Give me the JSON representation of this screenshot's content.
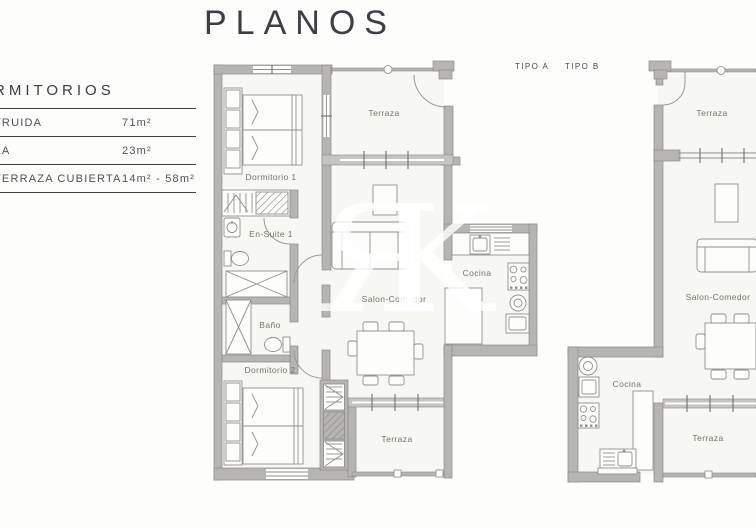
{
  "title": "PLANOS",
  "legend": {
    "heading": "RMITORIOS",
    "rows": [
      {
        "label": "TRUIDA",
        "value": "71m²"
      },
      {
        "label": "ZA",
        "value": "23m²"
      },
      {
        "label": "TERRAZA CUBIERTA",
        "value": "14m² - 58m²"
      }
    ]
  },
  "tabs": {
    "tipo_a": "TIPO A",
    "tipo_b": "TIPO B"
  },
  "watermark": {
    "char_r": "Я",
    "char_k": "K"
  },
  "colors": {
    "background": "#fdfdfc",
    "wall": "#b6b5b2",
    "wall_stroke": "#8c8b88",
    "floor": "#f7f7f4",
    "label_text": "#74746e",
    "heading_text": "#3e3e45"
  },
  "plan_a": {
    "name": "TIPO A",
    "rooms": {
      "terraza_top": "Terraza",
      "dormitorio1": "Dormitorio 1",
      "ensuite1": "En-Suite 1",
      "bano": "Baño",
      "salon": "Salon-Comedor",
      "cocina": "Cocina",
      "dormitorio2": "Dormitorio 2",
      "terraza_bottom": "Terraza"
    }
  },
  "plan_b": {
    "name": "TIPO B",
    "rooms": {
      "terraza_top": "Terraza",
      "salon": "Salon-Comedor",
      "cocina": "Cocina",
      "terraza_bottom": "Terraza"
    }
  }
}
